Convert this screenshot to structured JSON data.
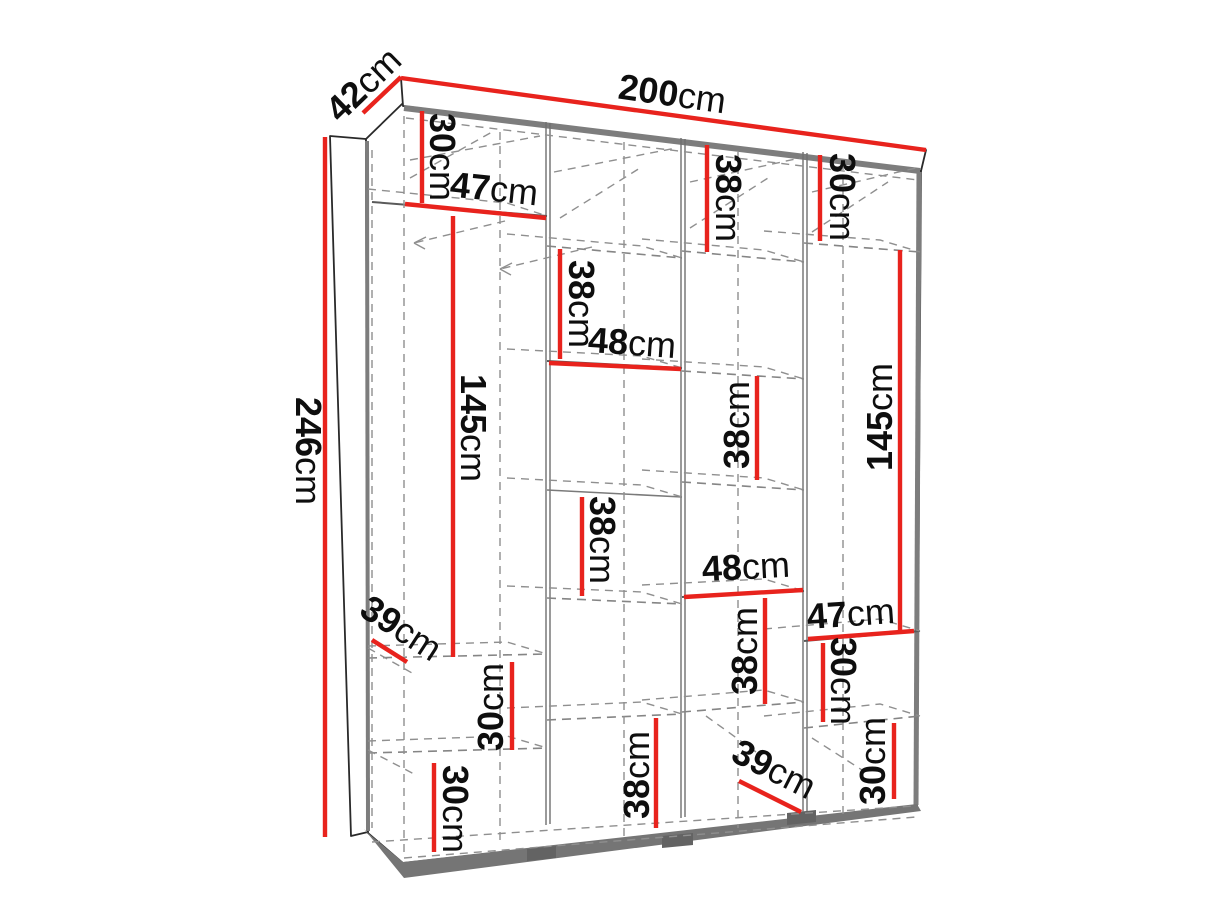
{
  "diagram": {
    "type": "furniture-dimension-diagram",
    "subject": "four-section wardrobe, 3/4 perspective view with dashed interior construction lines",
    "unit": "cm",
    "accent_color": "#e8231d",
    "overall_dimensions": {
      "width": "200cm",
      "height": "246cm",
      "depth": "42cm"
    },
    "section_widths": [
      "47cm",
      "48cm",
      "48cm",
      "47cm"
    ],
    "dimensions": [
      {
        "id": "depth-top",
        "value": "42",
        "unit": "cm",
        "text": {
          "x": 365,
          "y": 86,
          "rot": -44
        },
        "line": {
          "x1": 363,
          "y1": 113,
          "x2": 401,
          "y2": 77
        }
      },
      {
        "id": "width-top",
        "value": "200",
        "unit": "cm",
        "text": {
          "x": 672,
          "y": 96,
          "rot": 8
        },
        "line": {
          "x1": 401,
          "y1": 78,
          "x2": 926,
          "y2": 150
        }
      },
      {
        "id": "height-left",
        "value": "246",
        "unit": "cm",
        "text": {
          "x": 306,
          "y": 451,
          "rot": 90
        },
        "line": {
          "x1": 325,
          "y1": 137,
          "x2": 325,
          "y2": 837
        }
      },
      {
        "id": "col1-top-30",
        "value": "30",
        "unit": "cm",
        "text": {
          "x": 440,
          "y": 157,
          "rot": 90
        },
        "line": {
          "x1": 422,
          "y1": 111,
          "x2": 422,
          "y2": 203
        }
      },
      {
        "id": "col1-width-47",
        "value": "47",
        "unit": "cm",
        "text": {
          "x": 494,
          "y": 191,
          "rot": 6
        },
        "line": {
          "x1": 405,
          "y1": 204,
          "x2": 546,
          "y2": 218
        }
      },
      {
        "id": "col1-hang-145",
        "value": "145",
        "unit": "cm",
        "text": {
          "x": 471,
          "y": 428,
          "rot": 90
        },
        "line": {
          "x1": 453,
          "y1": 216,
          "x2": 453,
          "y2": 657
        }
      },
      {
        "id": "col1-depth-39",
        "value": "39",
        "unit": "cm",
        "text": {
          "x": 400,
          "y": 630,
          "rot": 33
        },
        "line": {
          "x1": 372,
          "y1": 640,
          "x2": 407,
          "y2": 662
        }
      },
      {
        "id": "col1-mid-30",
        "value": "30",
        "unit": "cm",
        "text": {
          "x": 493,
          "y": 707,
          "rot": -90
        },
        "line": {
          "x1": 512,
          "y1": 662,
          "x2": 512,
          "y2": 750
        }
      },
      {
        "id": "col1-bot-30",
        "value": "30",
        "unit": "cm",
        "text": {
          "x": 453,
          "y": 809,
          "rot": 90
        },
        "line": {
          "x1": 434,
          "y1": 763,
          "x2": 434,
          "y2": 852
        }
      },
      {
        "id": "col2-top-38",
        "value": "38",
        "unit": "cm",
        "text": {
          "x": 579,
          "y": 304,
          "rot": 90
        },
        "line": {
          "x1": 560,
          "y1": 249,
          "x2": 560,
          "y2": 359
        }
      },
      {
        "id": "col2-width-48",
        "value": "48",
        "unit": "cm",
        "text": {
          "x": 632,
          "y": 345,
          "rot": 4
        },
        "line": {
          "x1": 549,
          "y1": 363,
          "x2": 681,
          "y2": 369
        }
      },
      {
        "id": "col2-mid-38",
        "value": "38",
        "unit": "cm",
        "text": {
          "x": 600,
          "y": 540,
          "rot": 90
        },
        "line": {
          "x1": 582,
          "y1": 497,
          "x2": 582,
          "y2": 596
        }
      },
      {
        "id": "col2-bot-38",
        "value": "38",
        "unit": "cm",
        "text": {
          "x": 639,
          "y": 775,
          "rot": -90
        },
        "line": {
          "x1": 656,
          "y1": 718,
          "x2": 656,
          "y2": 828
        }
      },
      {
        "id": "col3-top-38",
        "value": "38",
        "unit": "cm",
        "text": {
          "x": 726,
          "y": 198,
          "rot": 90
        },
        "line": {
          "x1": 707,
          "y1": 145,
          "x2": 707,
          "y2": 252
        }
      },
      {
        "id": "col3-mid-38",
        "value": "38",
        "unit": "cm",
        "text": {
          "x": 739,
          "y": 425,
          "rot": -90
        },
        "line": {
          "x1": 757,
          "y1": 376,
          "x2": 757,
          "y2": 480
        }
      },
      {
        "id": "col3-width-48",
        "value": "48",
        "unit": "cm",
        "text": {
          "x": 746,
          "y": 569,
          "rot": -3
        },
        "line": {
          "x1": 684,
          "y1": 597,
          "x2": 803,
          "y2": 590
        }
      },
      {
        "id": "col3-low-38",
        "value": "38",
        "unit": "cm",
        "text": {
          "x": 747,
          "y": 651,
          "rot": -90
        },
        "line": {
          "x1": 765,
          "y1": 598,
          "x2": 765,
          "y2": 704
        }
      },
      {
        "id": "col3-depth-39",
        "value": "39",
        "unit": "cm",
        "text": {
          "x": 773,
          "y": 771,
          "rot": 27
        },
        "line": {
          "x1": 739,
          "y1": 781,
          "x2": 801,
          "y2": 812
        }
      },
      {
        "id": "col4-top-30",
        "value": "30",
        "unit": "cm",
        "text": {
          "x": 840,
          "y": 197,
          "rot": 90
        },
        "line": {
          "x1": 820,
          "y1": 155,
          "x2": 820,
          "y2": 241
        }
      },
      {
        "id": "col4-hang-145",
        "value": "145",
        "unit": "cm",
        "text": {
          "x": 882,
          "y": 417,
          "rot": -90
        },
        "line": {
          "x1": 900,
          "y1": 250,
          "x2": 900,
          "y2": 631
        }
      },
      {
        "id": "col4-width-47",
        "value": "47",
        "unit": "cm",
        "text": {
          "x": 851,
          "y": 616,
          "rot": -4
        },
        "line": {
          "x1": 808,
          "y1": 639,
          "x2": 914,
          "y2": 631
        }
      },
      {
        "id": "col4-mid-30",
        "value": "30",
        "unit": "cm",
        "text": {
          "x": 841,
          "y": 681,
          "rot": 90
        },
        "line": {
          "x1": 823,
          "y1": 643,
          "x2": 823,
          "y2": 722
        }
      },
      {
        "id": "col4-bot-30",
        "value": "30",
        "unit": "cm",
        "text": {
          "x": 875,
          "y": 761,
          "rot": -90
        },
        "line": {
          "x1": 894,
          "y1": 723,
          "x2": 894,
          "y2": 799
        }
      }
    ],
    "label_font_px": 36
  }
}
